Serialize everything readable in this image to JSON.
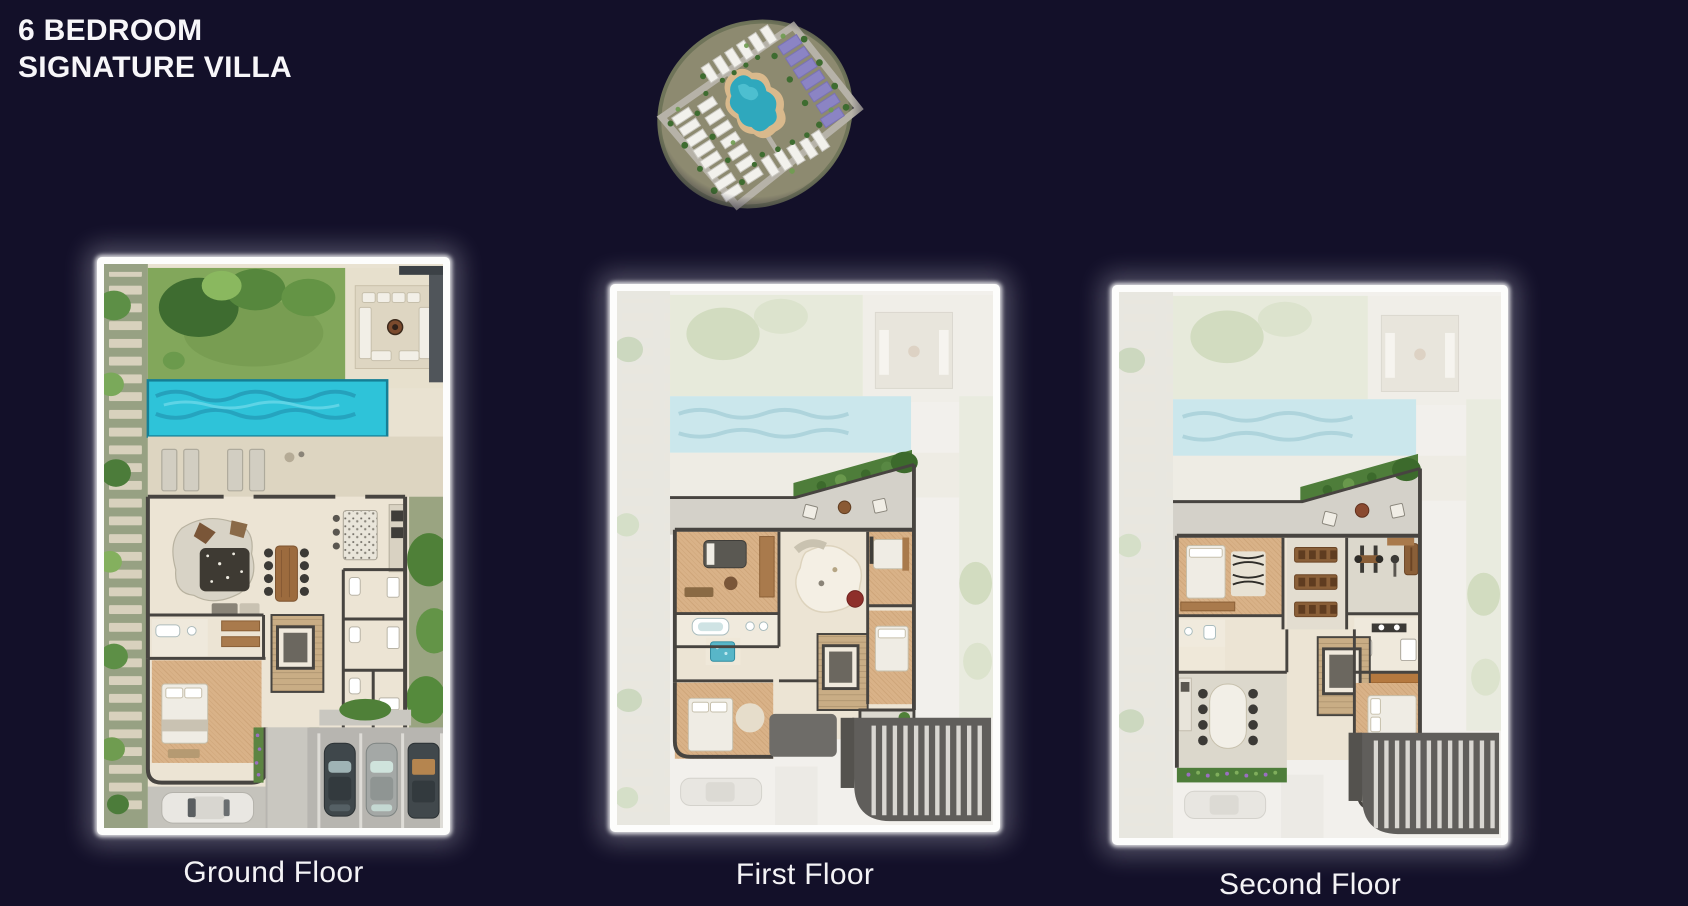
{
  "page": {
    "background_color": "#131029"
  },
  "header": {
    "title_line1": "6 BEDROOM",
    "title_line2": "SIGNATURE VILLA"
  },
  "masterplan": {
    "name": "masterplan-aerial-thumbnail",
    "pool_color": "#2fa8bd",
    "purple_roof_color": "#8b84c4"
  },
  "floor_plans": [
    {
      "id": "ground-floor",
      "label": "Ground Floor"
    },
    {
      "id": "first-floor",
      "label": "First Floor"
    },
    {
      "id": "second-floor",
      "label": "Second Floor"
    }
  ],
  "palette": {
    "background": "#131029",
    "text": "#f7f6f9",
    "pool": "#2ec3d9",
    "ghost_pool": "#cbe7ec",
    "lawn": "#82a75b",
    "interior_floor": "#ece4d4",
    "wall": "#474440",
    "frame_glow": "#ffffff",
    "pergola": "#605e5b"
  }
}
